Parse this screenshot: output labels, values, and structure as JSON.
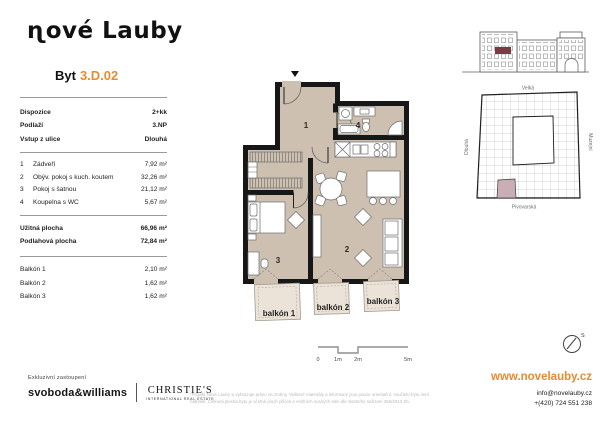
{
  "colors": {
    "accent": "#e88b2f",
    "floor": "#cec0b1",
    "wall": "#171717",
    "balcony_fill": "#ebe3d8",
    "elevation_highlight": "#7c3a42",
    "siteplan_highlight": "#c9aeb6"
  },
  "header": {
    "logo": "ɳové Lauby",
    "unit_label": "Byt",
    "unit_number": "3.D.02"
  },
  "info": {
    "details": [
      {
        "label": "Dispozice",
        "value": "2+kk"
      },
      {
        "label": "Podlaží",
        "value": "3.NP"
      },
      {
        "label": "Vstup z ulice",
        "value": "Dlouhá"
      }
    ],
    "rooms": [
      {
        "no": "1",
        "name": "Zádveří",
        "area": "7,92 m²"
      },
      {
        "no": "2",
        "name": "Obýv. pokoj s kuch. koutem",
        "area": "32,26 m²"
      },
      {
        "no": "3",
        "name": "Pokoj s šatnou",
        "area": "21,12 m²"
      },
      {
        "no": "4",
        "name": "Koupelna s WC",
        "area": "5,67 m²"
      }
    ],
    "totals": [
      {
        "label": "Užitná plocha",
        "value": "66,96 m²"
      },
      {
        "label": "Podlahová plocha",
        "value": "72,84 m²"
      }
    ],
    "balconies": [
      {
        "label": "Balkón 1",
        "value": "2,10 m²"
      },
      {
        "label": "Balkón 2",
        "value": "1,62 m²"
      },
      {
        "label": "Balkón 3",
        "value": "1,62 m²"
      }
    ]
  },
  "plan": {
    "rooms": {
      "r1": "1",
      "r2": "2",
      "r3": "3",
      "r4": "4"
    },
    "balconies": [
      "balkón 1",
      "balkón 2",
      "balkón 3"
    ],
    "scale_ticks": [
      "0",
      "1m",
      "2m",
      "5m"
    ],
    "compass": "S"
  },
  "siteplan": {
    "street_top": "Velká",
    "street_left": "Dlouhá",
    "street_right": "Muzejní",
    "street_bottom": "Pivovarská"
  },
  "footer": {
    "exclusive": "Exkluzivní zastoupení",
    "agency1": "svoboda&williams",
    "agency2": "CHRISTIE'S",
    "agency2_sub": "INTERNATIONAL REAL ESTATE",
    "disclaimer_line1": "*Projekt Nové Lauby si vyhrazuje právo na změny. Veškeré materiály a informace jsou pouze orientační, součástí bytu není",
    "disclaimer_line2": "nábytek. Celková plocha bytu je včetně ploch příček a vnitřních nosných stěn dle vlastního nařízení 366/2013 Sb.",
    "web": "www.novelauby.cz",
    "email": "info@novelauby.cz",
    "phone": "+(420) 724 551 238"
  }
}
